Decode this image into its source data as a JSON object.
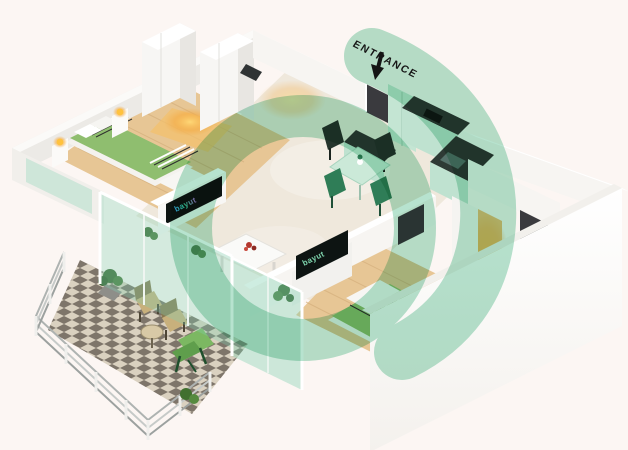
{
  "entrance": {
    "label": "ENTRANCE",
    "arrow_icon": "down-arrow"
  },
  "tv": {
    "brand": "bayut"
  },
  "watermark": {
    "name": "bayut-logo",
    "color": "#6FC7A0",
    "opacity": "0.5"
  },
  "colors": {
    "background": "#FCF6F3",
    "wall_white": "#FFFFFF",
    "wall_shade": "#ECEAE6",
    "wall_face": "#F7F5F2",
    "wood_floor": "#E7C695",
    "wood_line": "#D4AF7C",
    "marble_floor": "#EFE8DC",
    "checker_dark": "#7E756A",
    "checker_light": "#DAD1C0",
    "bed_green": "#8FBE6F",
    "counter_dark": "#2E3A35",
    "cabinet_mint": "#C4E5D3",
    "glass_teal": "#7ED0B0",
    "lamp_yellow": "#FFC23E",
    "warm_glow": "#F5A93F",
    "plant_green": "#3E6B34",
    "chair_dark": "#25352D",
    "chair_green": "#2F7D57",
    "khaki": "#C8B07C",
    "red_accent": "#B3382E",
    "door_dark": "#3A3A3E",
    "tv_black": "#0D1412",
    "text_dark": "#161616"
  }
}
